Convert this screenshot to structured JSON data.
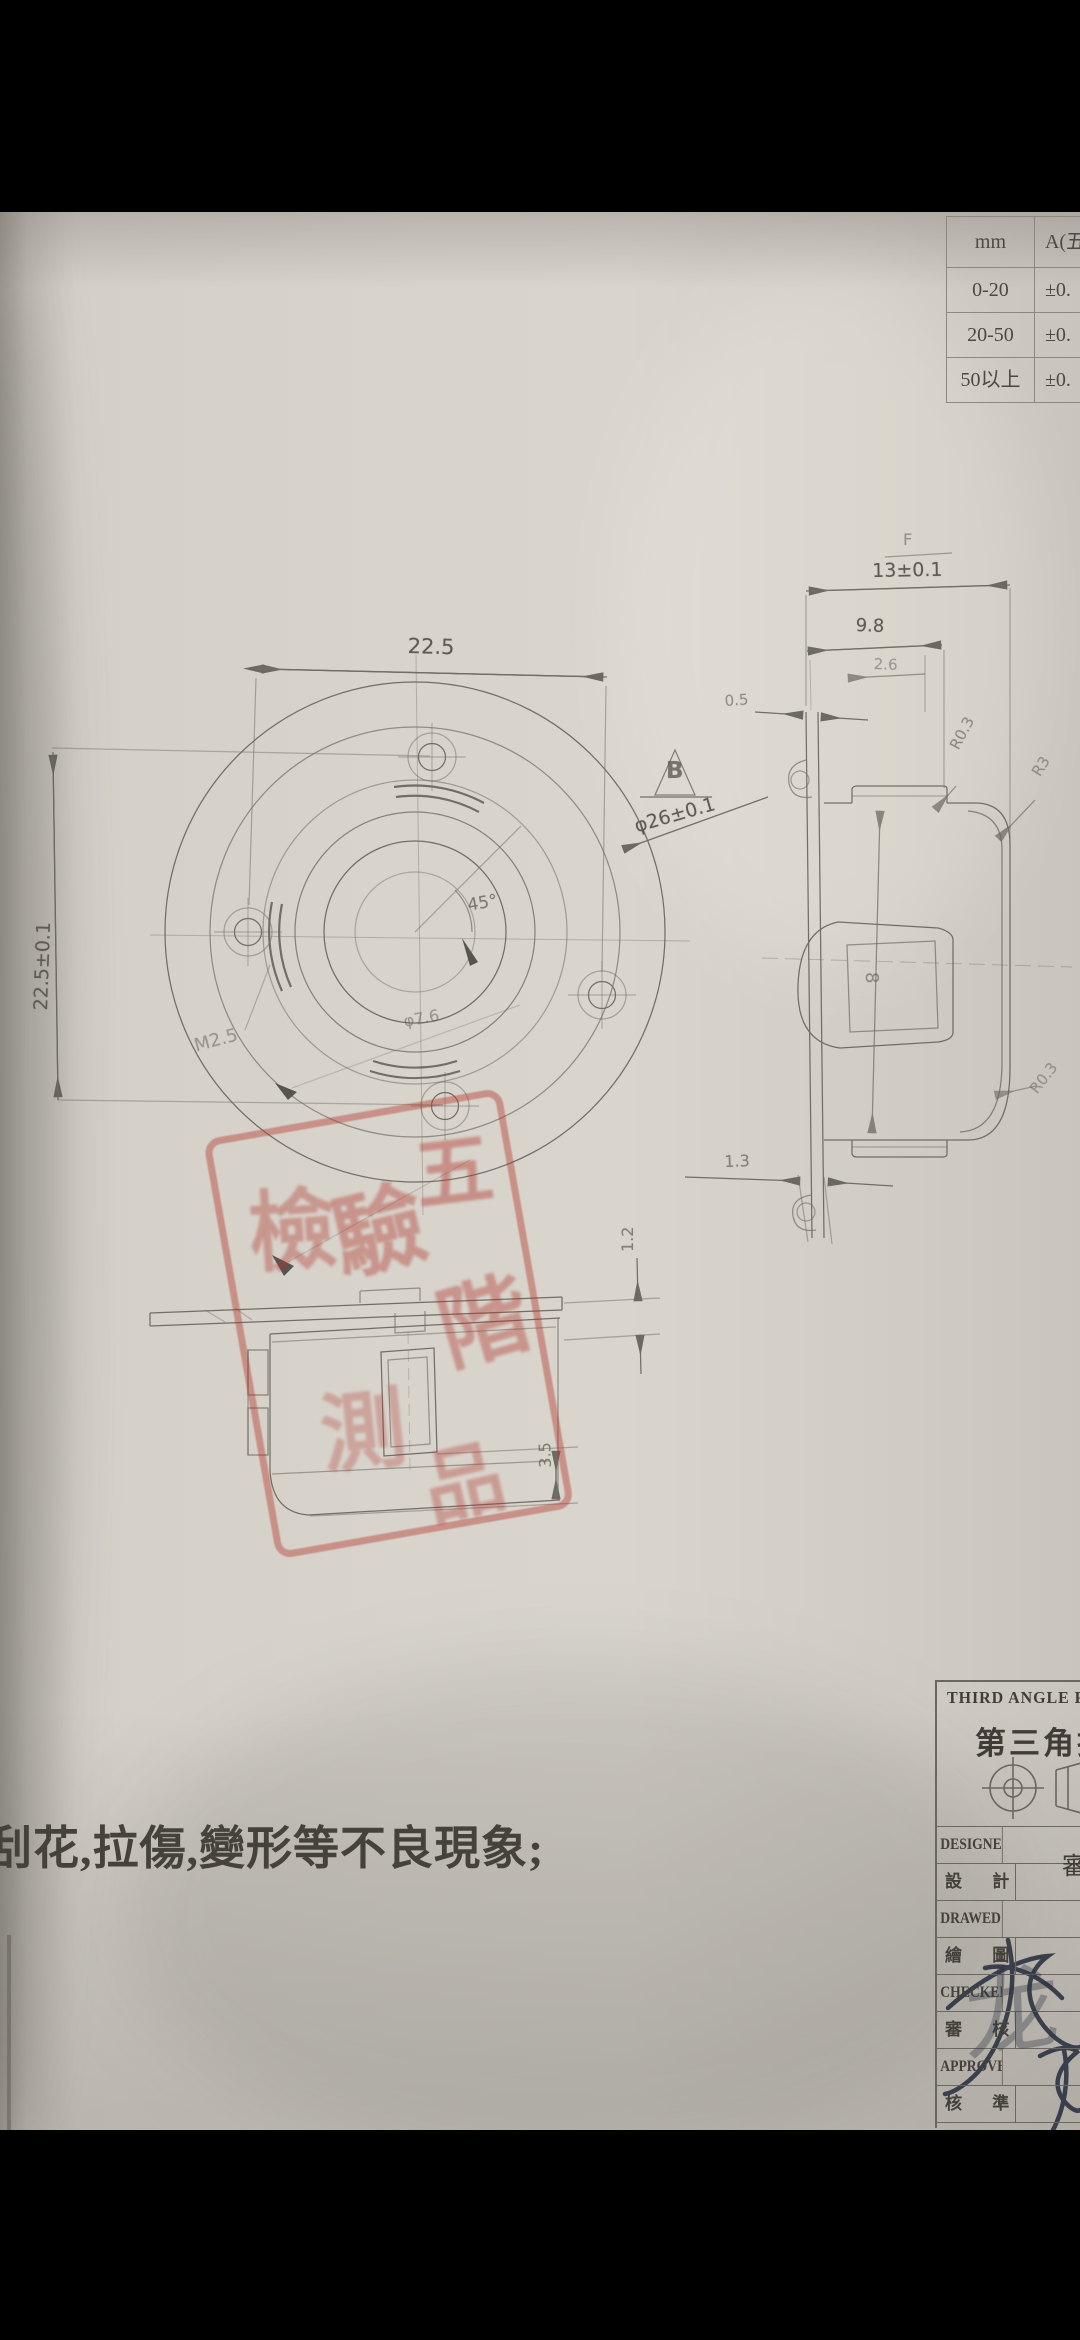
{
  "tolerance_table": {
    "unit_header": "mm",
    "grade_header": "A(五",
    "rows": [
      {
        "range": "0-20",
        "tolerance": "±0."
      },
      {
        "range": "20-50",
        "tolerance": "±0."
      },
      {
        "range": "50以上",
        "tolerance": "±0."
      }
    ]
  },
  "front_view": {
    "dim_horizontal": "22.5",
    "dim_vertical": "22.5±0.1",
    "angle_label": "45°",
    "datum_flag": "B",
    "diameter_label": "φ26±0.1",
    "thread_label": "M2.5",
    "hole_label": "φ7.6"
  },
  "side_view": {
    "finish_mark": "F",
    "dim_width": "13±0.1",
    "dim_inner_width": "9.8",
    "dim_step": "2.6",
    "dim_flange_thickness": "0.5",
    "radius_top": "R0.3",
    "radius_corner": "R3",
    "radius_bottom": "R0.3",
    "dim_bottom_flange": "1.3",
    "bore_label": "8"
  },
  "bottom_view": {
    "dim_gap": "1.2",
    "dim_slot": "3.5"
  },
  "note_text": "刮花,拉傷,變形等不良現象;",
  "stamp": {
    "characters": [
      "檢",
      "驗",
      "五",
      "階",
      "測",
      "品"
    ]
  },
  "title_block": {
    "title_en": "THIRD ANGLE PROJECTION",
    "title_zh": "第三角投影",
    "rows": [
      {
        "en": "DESIGNED",
        "zh": "設 計"
      },
      {
        "en": "DRAWED",
        "zh": "繪 圖"
      },
      {
        "en": "CHECKED",
        "zh": "審 核"
      },
      {
        "en": "APPROVED",
        "zh": "核 準"
      }
    ],
    "partial_char": "審",
    "signature_script": "龙"
  },
  "colors": {
    "stamp_red": "#b2352c",
    "pencil": "#5b5851",
    "paper": "#d5d1c9",
    "signature_ink": "#2c3342"
  }
}
